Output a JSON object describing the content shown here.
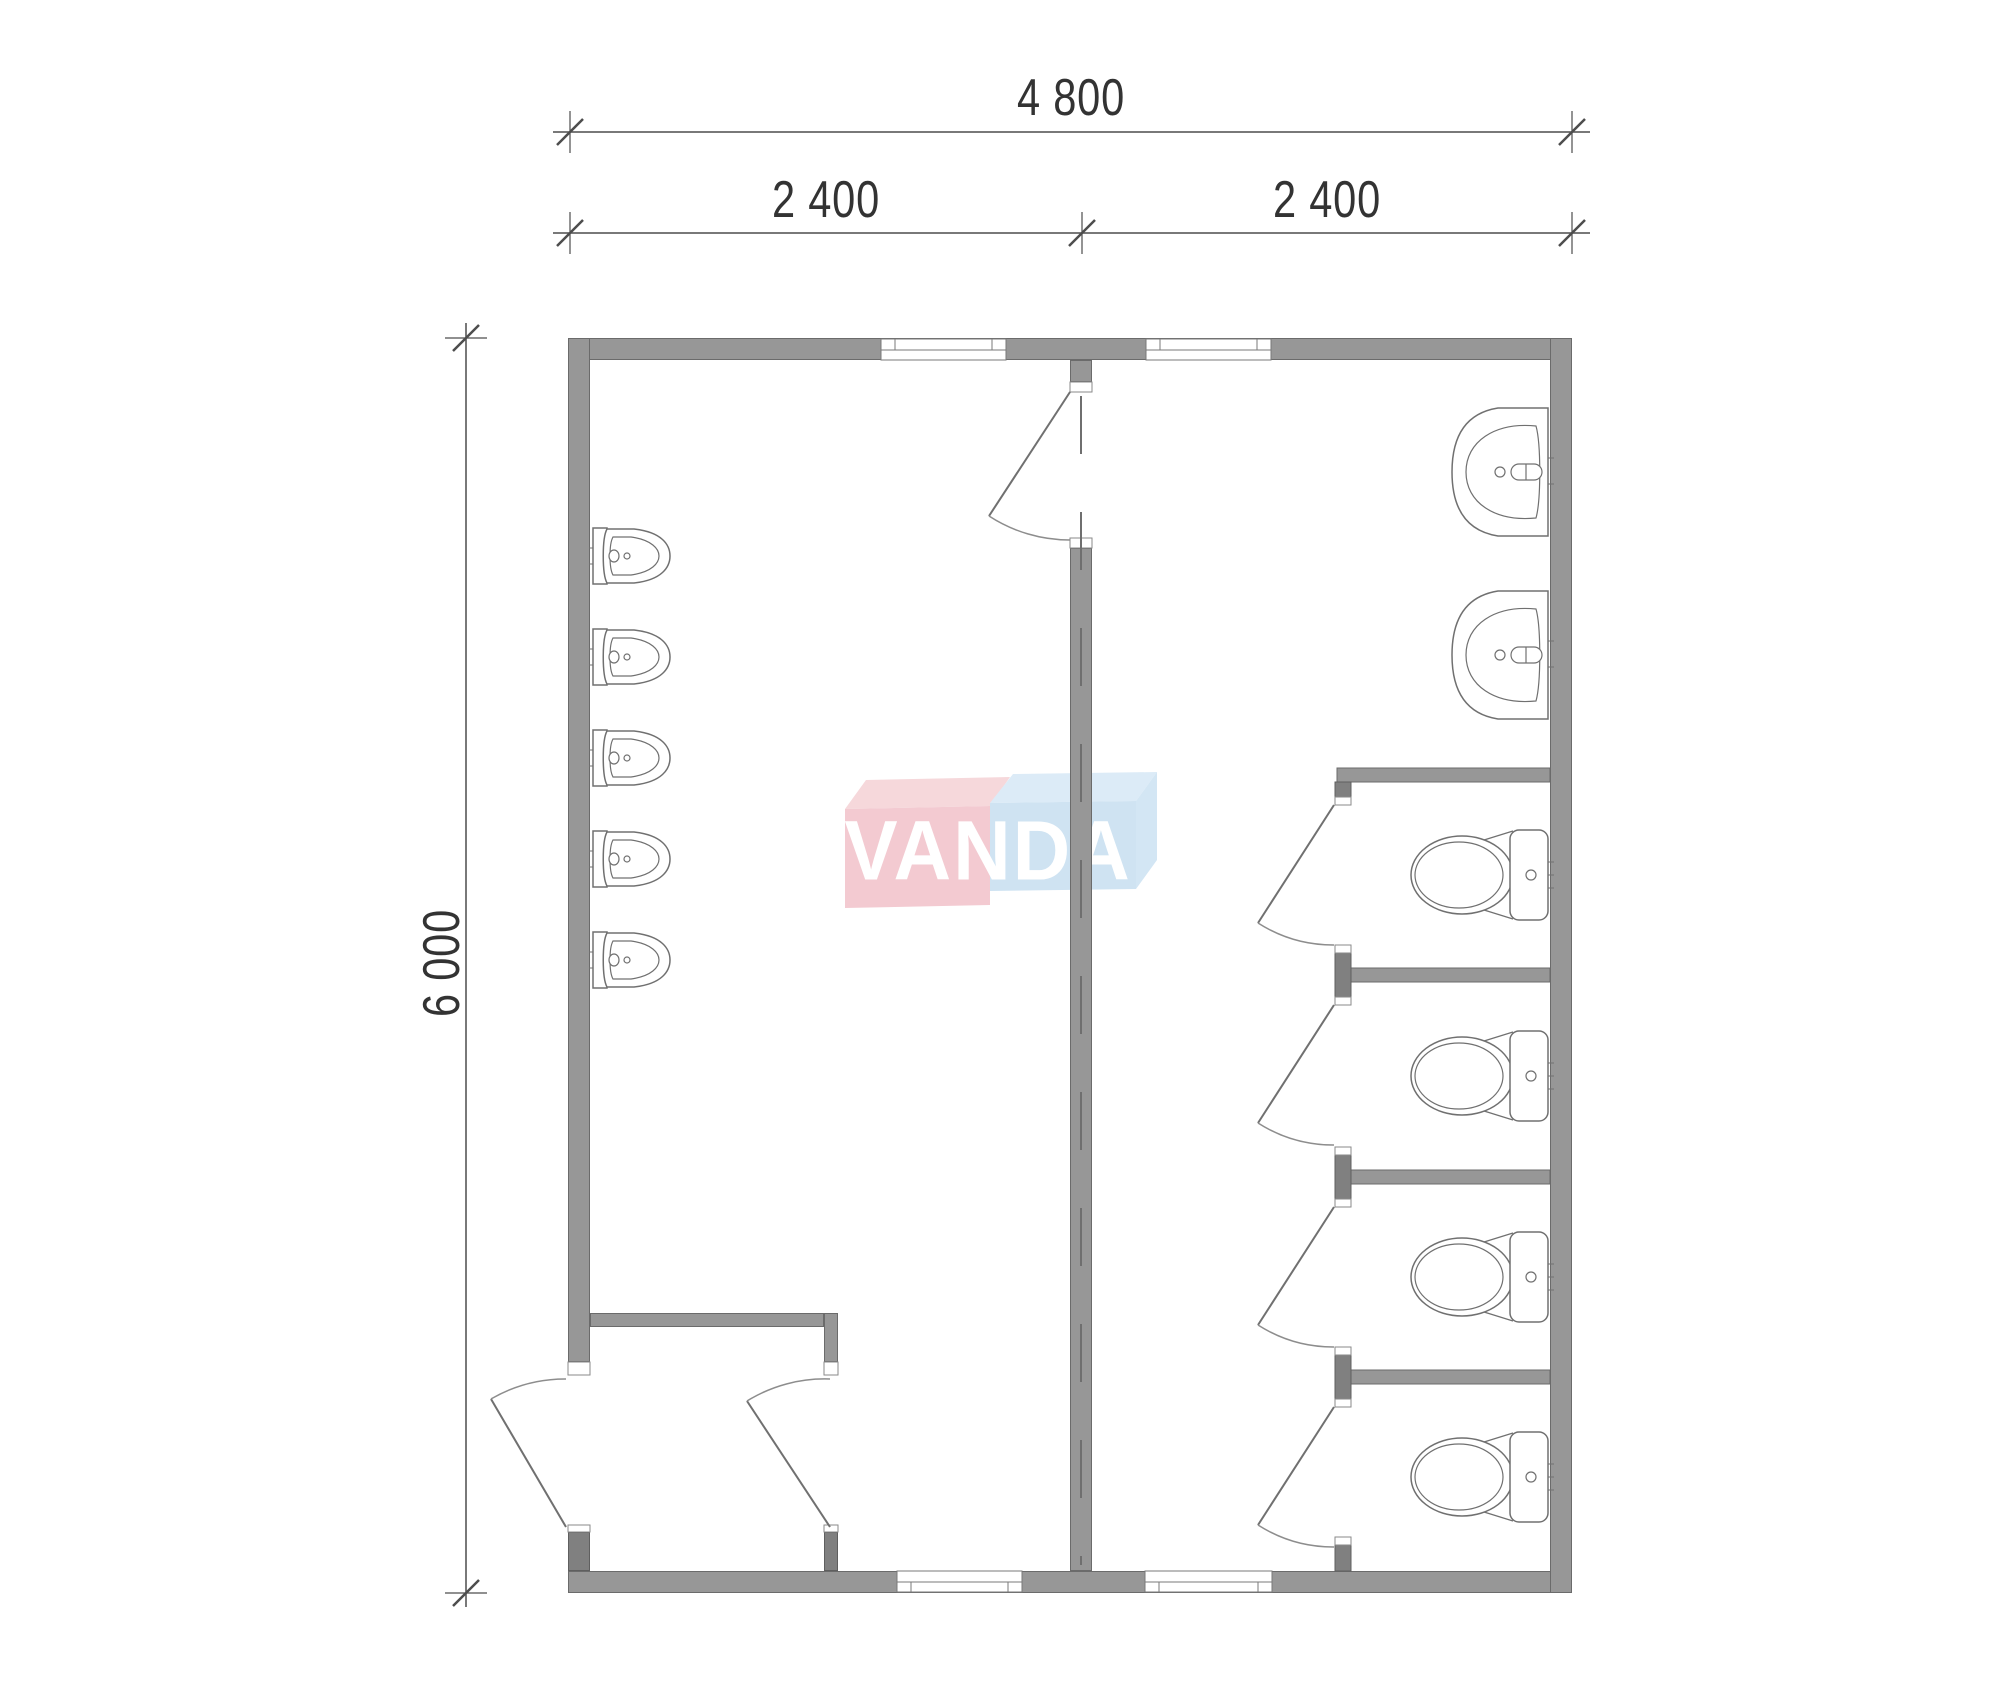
{
  "drawing": {
    "type": "floor-plan",
    "description": "Sanitary module plan with urinal room and WC stall room"
  },
  "dimensions": {
    "top_total": "4 800",
    "top_left": "2 400",
    "top_right": "2 400",
    "left_height": "6 000"
  },
  "logo": {
    "text": "VANDA",
    "pink_front": "#f3cad1",
    "pink_top": "#f6d8db",
    "blue_front": "#cfe3f2",
    "blue_top": "#dcebf7",
    "blue_side": "#d3e6f4",
    "letter_color": "#ffffff"
  },
  "colors": {
    "wall": "#979797",
    "wall_edge": "#6b6b6b",
    "post": "#808080",
    "post_edge": "#5f5f5f",
    "line": "#707070",
    "arc": "#8d8d8d",
    "dim": "#4d4d4d",
    "text": "#333333"
  },
  "fixtures": {
    "urinals": {
      "count": 5,
      "centers_y": [
        556,
        657,
        758,
        859,
        960
      ]
    },
    "sinks": {
      "count": 2,
      "centers_y": [
        472,
        655
      ]
    },
    "toilets": {
      "count": 4,
      "centers_y": [
        875,
        1076,
        1277,
        1477
      ]
    }
  },
  "stalls": {
    "count": 4,
    "partition_tops_y": [
      768,
      968,
      1170,
      1370
    ],
    "partition_x": 1337,
    "partition_w": 213,
    "partition_h": 14
  },
  "windows": [
    {
      "side": "top",
      "x": 881,
      "w": 125
    },
    {
      "side": "top",
      "x": 1146,
      "w": 125
    },
    {
      "side": "bottom",
      "x": 897,
      "w": 125
    },
    {
      "side": "bottom",
      "x": 1145,
      "w": 127
    }
  ],
  "doors": [
    {
      "name": "main-room-door",
      "hinge": [
        1070,
        392
      ],
      "leaf": [
        989,
        516
      ],
      "closed": [
        1070,
        540
      ],
      "sweep": 0
    },
    {
      "name": "stall-door-1",
      "hinge": [
        1334,
        805
      ],
      "leaf": [
        1258,
        923
      ],
      "closed": [
        1334,
        945
      ],
      "sweep": 0
    },
    {
      "name": "stall-door-2",
      "hinge": [
        1334,
        1005
      ],
      "leaf": [
        1258,
        1123
      ],
      "closed": [
        1334,
        1145
      ],
      "sweep": 0
    },
    {
      "name": "stall-door-3",
      "hinge": [
        1334,
        1207
      ],
      "leaf": [
        1258,
        1325
      ],
      "closed": [
        1334,
        1347
      ],
      "sweep": 0
    },
    {
      "name": "stall-door-4",
      "hinge": [
        1334,
        1407
      ],
      "leaf": [
        1258,
        1525
      ],
      "closed": [
        1334,
        1547
      ],
      "sweep": 0
    },
    {
      "name": "entrance-door",
      "hinge": [
        566,
        1527
      ],
      "leaf": [
        491,
        1399
      ],
      "closed": [
        566,
        1379
      ],
      "sweep": 1
    },
    {
      "name": "vestibule-door",
      "hinge": [
        830,
        1527
      ],
      "leaf": [
        747,
        1401
      ],
      "closed": [
        830,
        1379
      ],
      "sweep": 1
    }
  ],
  "axis_line": {
    "x": 1081,
    "y1": 396,
    "y2": 1565,
    "dash": "58 58"
  }
}
